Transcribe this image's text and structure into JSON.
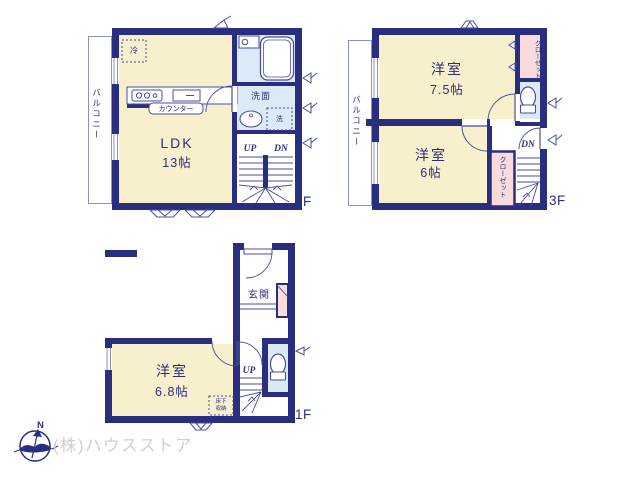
{
  "company": {
    "name": "(株)ハウスストア",
    "compass_n": "N"
  },
  "colors": {
    "wall_navy": "#2a2e7e",
    "room_cream": "#f8efcd",
    "wet_blue": "#dce9f6",
    "closet_pink": "#f8dcdc",
    "fixture_line": "#474f9b",
    "light_line": "#8a92c0",
    "company_gray": "#cfcfcf"
  },
  "floor1": {
    "label": "1F",
    "entrance": "玄関",
    "room_name": "洋室",
    "room_size": "6.8帖",
    "storage_line1": "床下",
    "storage_line2": "収納",
    "up": "UP"
  },
  "floor2": {
    "label": "2F",
    "ldk_name": "LDK",
    "ldk_size": "13帖",
    "balcony": "バルコニー",
    "fridge": "冷",
    "counter": "カウンター",
    "washroom": "洗面",
    "washer": "洗",
    "up": "UP",
    "down": "DN"
  },
  "floor3": {
    "label": "3F",
    "balcony": "バルコニー",
    "room1_name": "洋室",
    "room1_size": "7.5帖",
    "room2_name": "洋室",
    "room2_size": "6帖",
    "closet1": "クローゼット",
    "closet2": "クローゼット",
    "down": "DN"
  }
}
